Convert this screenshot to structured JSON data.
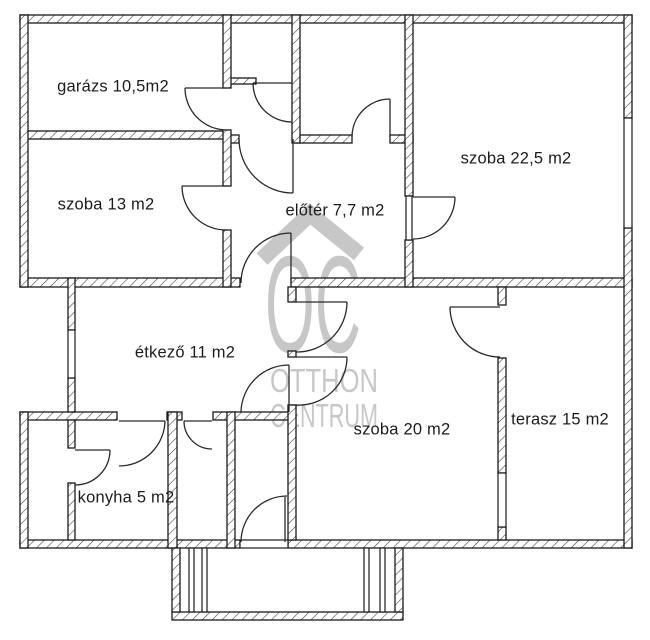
{
  "title": "floor-plan",
  "watermark": {
    "logo": "OC",
    "line1": "OTTHON",
    "line2": "CENTRUM",
    "color": "#c7c7c7"
  },
  "rooms": [
    {
      "id": "garazs",
      "label": "garázs 10,5m2"
    },
    {
      "id": "szoba13",
      "label": "szoba 13 m2"
    },
    {
      "id": "eloter",
      "label": "előtér 7,7 m2"
    },
    {
      "id": "szoba225",
      "label": "szoba 22,5 m2"
    },
    {
      "id": "etkezo",
      "label": "étkező 11 m2"
    },
    {
      "id": "szoba20",
      "label": "szoba 20 m2"
    },
    {
      "id": "terasz",
      "label": "terasz 15 m2"
    },
    {
      "id": "konyha",
      "label": "konyha 5 m2"
    }
  ],
  "colors": {
    "wall_line": "#1a1a1a",
    "door_line": "#2a2a2a",
    "watermark_gray": "#c7c7c7",
    "background": "#ffffff"
  }
}
